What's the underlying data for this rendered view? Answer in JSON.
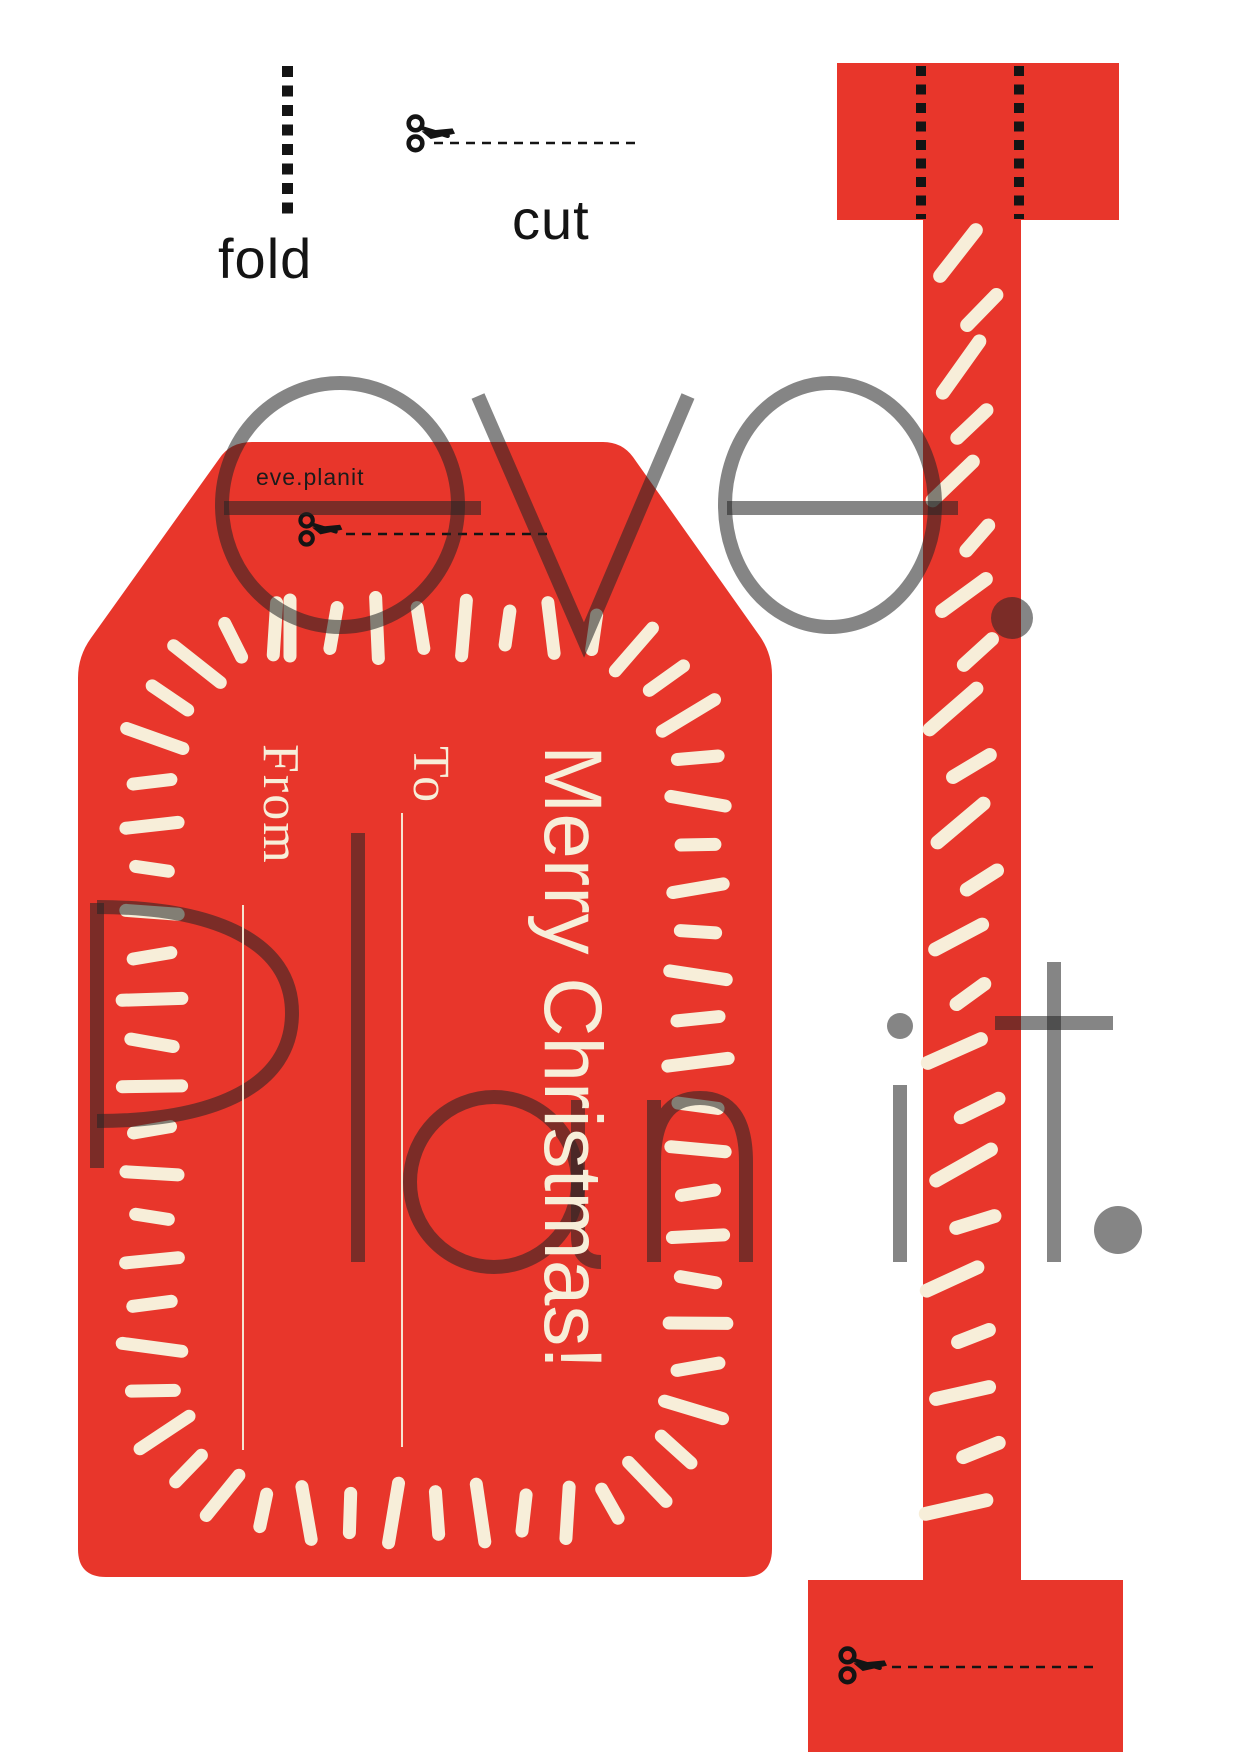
{
  "marks": {
    "fold_label": "fold",
    "cut_label": "cut"
  },
  "brand": {
    "tag_credit": "eve.planit",
    "watermark_line1": "eve.",
    "watermark_line2": "Planit."
  },
  "tag": {
    "from_label": "From",
    "to_label": "To",
    "greeting": "Merry Christmas!"
  },
  "icons": {
    "scissors": "scissors-icon",
    "fold_line": "fold-dashed-line"
  },
  "colors": {
    "red": "#e8362b",
    "cream": "#f7eed9",
    "ink": "#141414",
    "watermark": "rgba(38,38,38,0.56)"
  }
}
